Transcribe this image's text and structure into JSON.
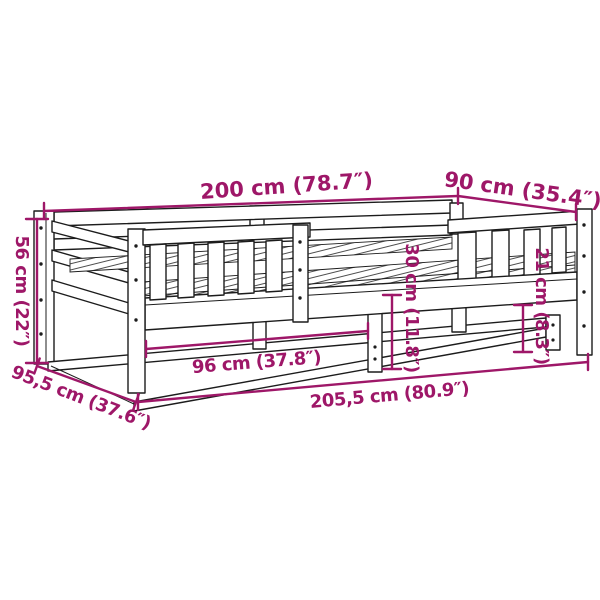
{
  "diagram": {
    "colors": {
      "accent": "#9E1768",
      "line": "#1C1C1C",
      "bg": "#FFFFFF"
    },
    "dimensions": [
      {
        "id": "top-length",
        "label": "200 cm (78.7″)"
      },
      {
        "id": "top-width",
        "label": "90 cm (35.4″)"
      },
      {
        "id": "left-height",
        "label": "56 cm (22″)"
      },
      {
        "id": "left-depth",
        "label": "95,5 cm (37.6″)"
      },
      {
        "id": "inner-length",
        "label": "96 cm (37.8″)"
      },
      {
        "id": "overall-length",
        "label": "205,5 cm (80.9″)"
      },
      {
        "id": "clearance",
        "label": "30 cm (11.8″)"
      },
      {
        "id": "rail-height",
        "label": "21 cm (8.3″)"
      }
    ]
  }
}
